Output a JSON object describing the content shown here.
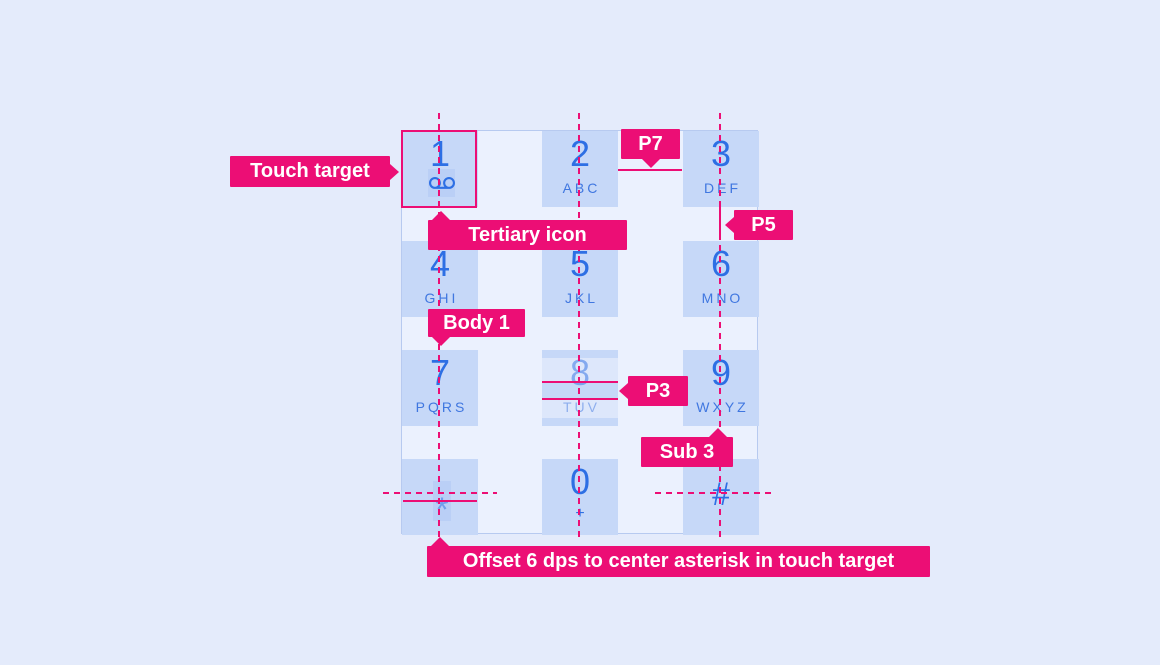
{
  "colors": {
    "page_bg": "#E4EBFB",
    "panel_bg": "#EBF1FE",
    "panel_border": "#B7CAF0",
    "key_bg": "#C6D8F8",
    "digit_blue": "#2D6FE4",
    "letters_blue": "#4077E0",
    "accent_pink": "#EC0E75",
    "highlight_blue": "#BACFF6"
  },
  "annotations": {
    "touch_target": "Touch target",
    "tertiary_icon": "Tertiary icon",
    "p7": "P7",
    "p5": "P5",
    "body1": "Body 1",
    "p3": "P3",
    "sub3": "Sub 3",
    "offset_note": "Offset 6 dps to center asterisk in touch target"
  },
  "keypad": {
    "keys": [
      {
        "digit": "1",
        "letters": "",
        "icon": "voicemail-icon"
      },
      {
        "digit": "2",
        "letters": "ABC"
      },
      {
        "digit": "3",
        "letters": "DEF"
      },
      {
        "digit": "4",
        "letters": "GHI"
      },
      {
        "digit": "5",
        "letters": "JKL"
      },
      {
        "digit": "6",
        "letters": "MNO"
      },
      {
        "digit": "7",
        "letters": "PQRS"
      },
      {
        "digit": "8",
        "letters": "TUV"
      },
      {
        "digit": "9",
        "letters": "WXYZ"
      },
      {
        "digit": "*",
        "letters": ""
      },
      {
        "digit": "0",
        "letters": "+"
      },
      {
        "digit": "#",
        "letters": ""
      }
    ]
  }
}
